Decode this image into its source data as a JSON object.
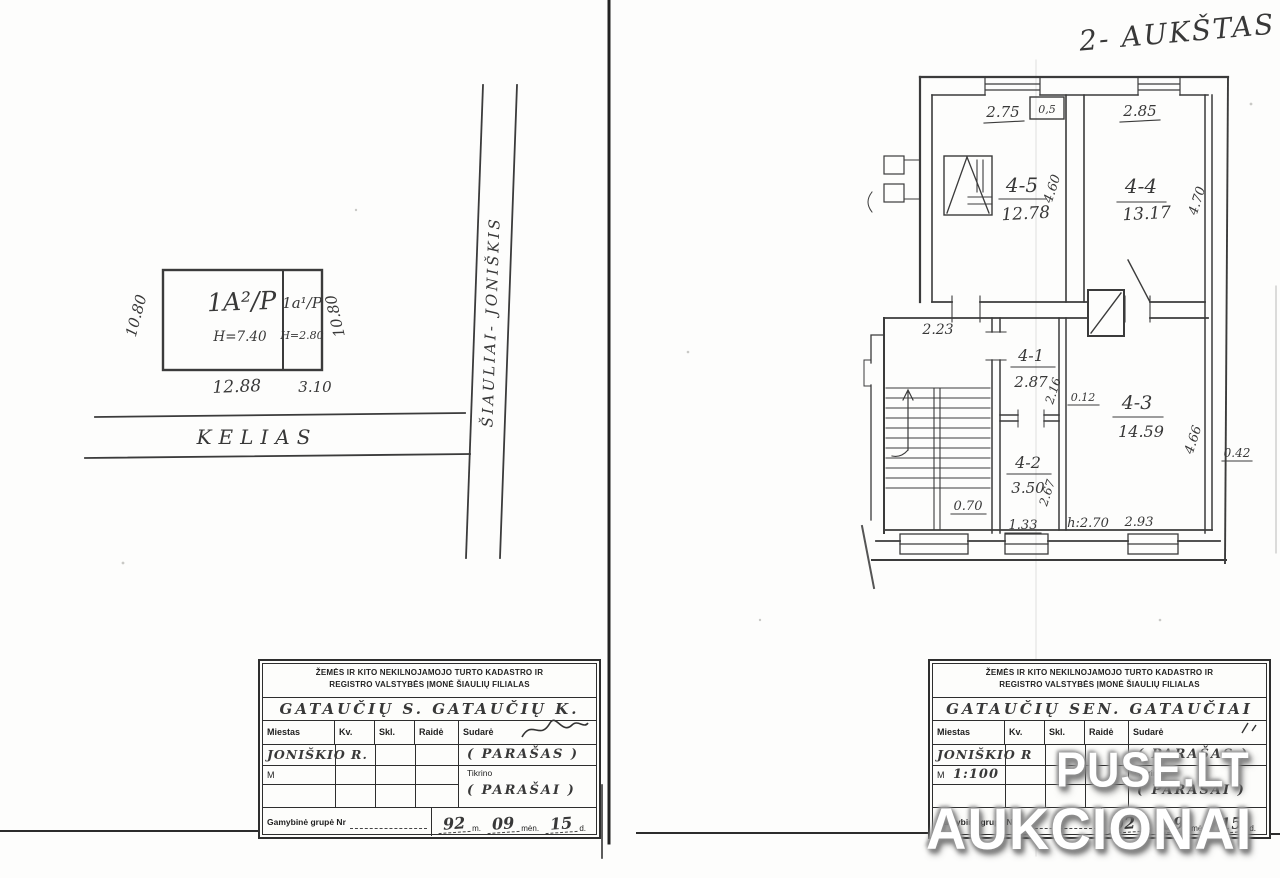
{
  "left_page": {
    "building": {
      "main_code": "1A²/P",
      "main_height": "H=7.40",
      "annex_code": "1a¹/P",
      "annex_height": "H=2.80",
      "dim_left": "10.80",
      "dim_right": "10.80",
      "dim_bottom_main": "12.88",
      "dim_bottom_annex": "3.10"
    },
    "road_label": "KELIAS",
    "highway_label": "ŠIAULIAI- JONIŠKIS"
  },
  "right_page": {
    "title": "2- AUKŠTAS",
    "plan": {
      "room45_id": "4-5",
      "room45_area": "12.78",
      "room45_top": "2.75",
      "room45_side": "4.60",
      "room44_id": "4-4",
      "room44_area": "13.17",
      "room44_top": "2.85",
      "room44_side": "4.70",
      "room41_id": "4-1",
      "room41_area": "2.87",
      "room41_side": "2.16",
      "room42_id": "4-2",
      "room42_area": "3.50",
      "room42_side": "2.67",
      "room42_bottom": "1.33",
      "room43_id": "4-3",
      "room43_area": "14.59",
      "room43_side": "4.66",
      "room43_bottom": "2.93",
      "room43_height": "h:2.70",
      "stair_top": "2.23",
      "stair_bottom": "0.70",
      "vent": "0,5",
      "wall_thin": "0.12",
      "wall_outer": "0.42"
    }
  },
  "stamp_left": {
    "header1": "ŽEMĖS IR KITO NEKILNOJAMOJO TURTO KADASTRO IR",
    "header2": "REGISTRO VALSTYBĖS ĮMONĖ ŠIAULIŲ FILIALAS",
    "location": "GATAUČIŲ S. GATAUČIŲ K.",
    "col_city": "Miestas",
    "col_kv": "Kv.",
    "col_skl": "Skl.",
    "col_raide": "Raidė",
    "col_sudare": "Sudarė",
    "city_value": "JONIŠKIO R.",
    "signature1": "( PARAŠAS )",
    "scale_label": "M",
    "checked_label": "Tikrino",
    "signature2": "( PARAŠAI )",
    "group_label": "Gamybinė grupė Nr",
    "year": "92",
    "m_suffix": "m.",
    "month": "09",
    "month_suffix": "mėn.",
    "day": "15",
    "day_suffix": "d."
  },
  "stamp_right": {
    "header1": "ŽEMĖS IR KITO NEKILNOJAMOJO TURTO KADASTRO IR",
    "header2": "REGISTRO VALSTYBĖS ĮMONĖ ŠIAULIŲ FILIALAS",
    "location": "GATAUČIŲ SEN. GATAUČIAI",
    "col_city": "Miestas",
    "col_kv": "Kv.",
    "col_skl": "Skl.",
    "col_raide": "Raidė",
    "col_sudare": "Sudarė",
    "city_value": "JONIŠKIO R",
    "signature1": "( PARAŠAS )",
    "scale_label": "M",
    "scale_value": "1:100",
    "checked_label": "Tikrino",
    "signature2": "( PARAŠAI )",
    "group_label": "Gamybinė grupė Nr",
    "year": "92",
    "m_suffix": "m.",
    "month": "09",
    "month_suffix": "mėn.",
    "day": "15",
    "day_suffix": "d."
  },
  "watermark": {
    "line1": "PUSE.LT",
    "line2": "AUKCIONAI"
  }
}
